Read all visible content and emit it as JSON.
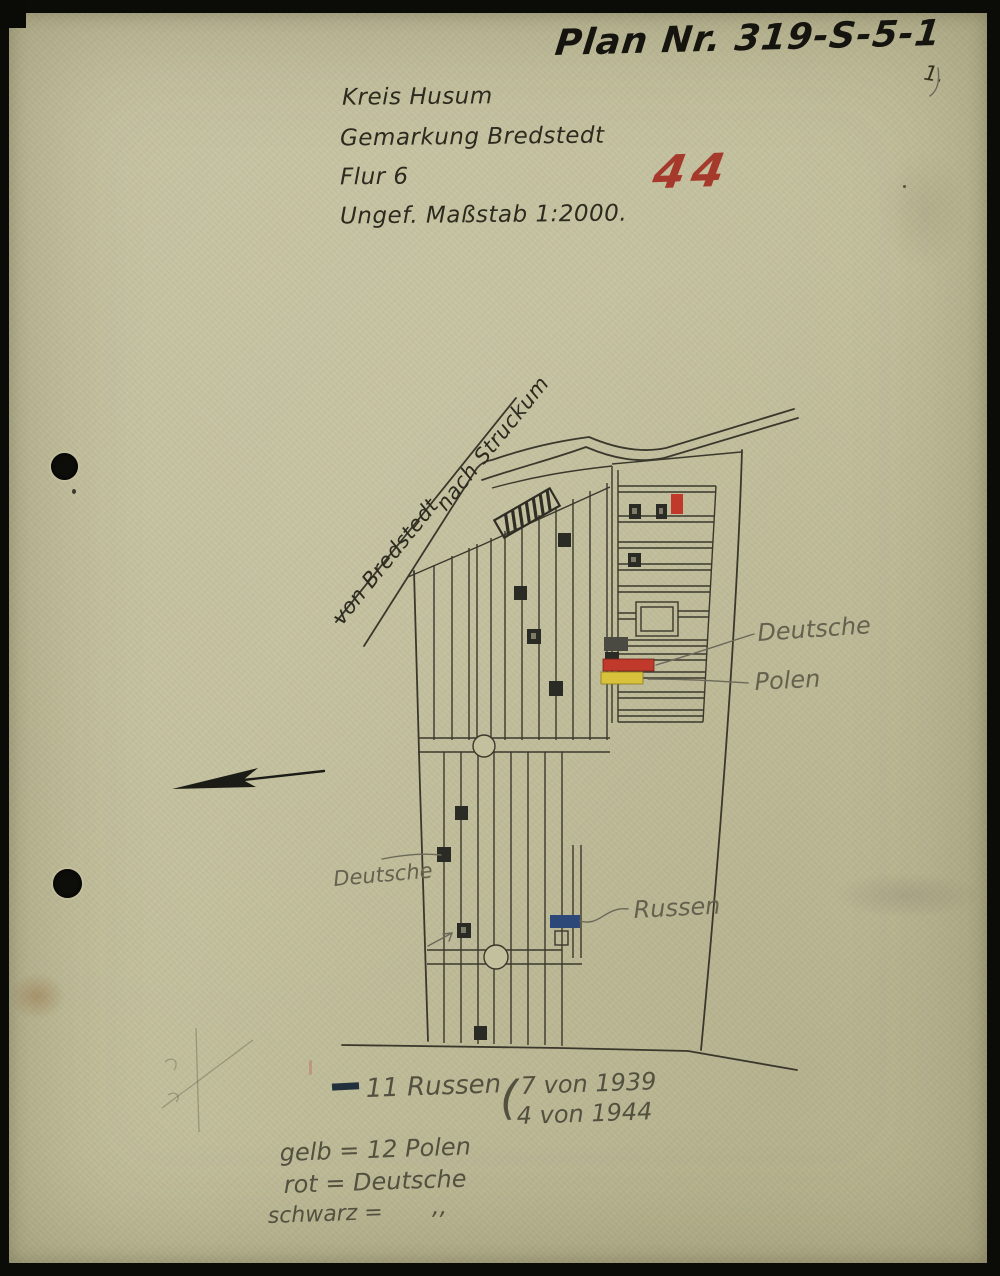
{
  "document": {
    "plan_title": "Plan Nr. 319-S-5-1",
    "page_number": "1.",
    "red_number": "44",
    "header_lines": [
      "Kreis Husum",
      "Gemarkung Bredstedt",
      "Flur 6",
      "Ungef. Maßstab 1:2000."
    ]
  },
  "map": {
    "road_label_upper": "nach Struckum",
    "road_label_lower": "von Bredstedt",
    "note_deutsche_upper": "Deutsche",
    "note_polen": "Polen",
    "note_deutsche_lower": "Deutsche",
    "note_russen": "Russen"
  },
  "legend": {
    "russen_count": "11 Russen",
    "russen_paren": "(",
    "russen_detail_1": "7 von 1939",
    "russen_detail_2": "4 von 1944",
    "gelb_line": "gelb = 12 Polen",
    "rot_line": "rot = Deutsche",
    "schwarz_line": "schwarz =",
    "schwarz_ditto": "‚‚"
  },
  "colors": {
    "paper": "#c3c09d",
    "ink": "#3a382c",
    "pencil": "#6b695a",
    "grave_black": "#2b2b26",
    "grave_red": "#c0392b",
    "grave_yellow": "#d8c23c",
    "grave_blue": "#2c4878",
    "stamp_red": "#a5392b",
    "legend_dash_blue_black": "#22303d"
  }
}
